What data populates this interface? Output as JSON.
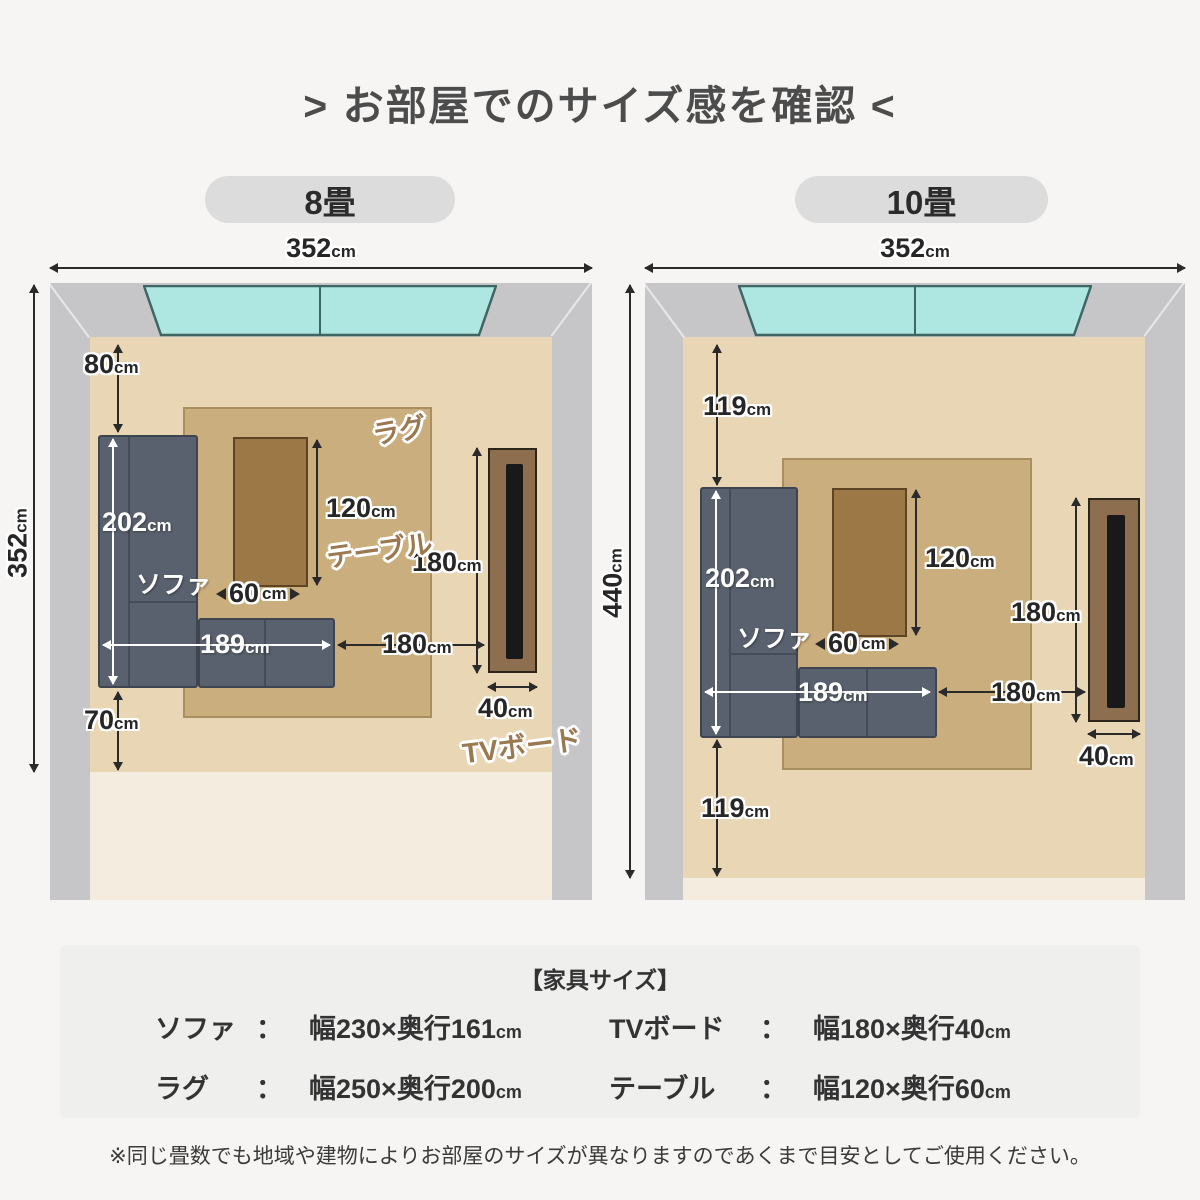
{
  "title": "> お部屋でのサイズ感を確認 <",
  "unit": "cm",
  "left": {
    "badge": "8畳",
    "width": "352",
    "height": "352",
    "top_gap": "80",
    "sofa_depth": "202",
    "sofa": "ソファ",
    "rug": "ラグ",
    "table": "テーブル",
    "table_h": "120",
    "table_w": "60",
    "sofa_w": "189",
    "dist": "180",
    "tv_h": "180",
    "tv_w": "40",
    "tv": "TVボード",
    "bottom_gap": "70"
  },
  "right": {
    "badge": "10畳",
    "width": "352",
    "height": "440",
    "top_gap": "119",
    "sofa_depth": "202",
    "sofa": "ソファ",
    "table_h": "120",
    "table_w": "60",
    "sofa_w": "189",
    "dist": "180",
    "tv_h": "180",
    "tv_w": "40",
    "bottom_gap": "119"
  },
  "panel": {
    "heading": "【家具サイズ】",
    "colon": "：",
    "items": [
      {
        "label": "ソファ",
        "value": "幅230×奥行161"
      },
      {
        "label": "TVボード",
        "value": "幅180×奥行40"
      },
      {
        "label": "ラグ",
        "value": "幅250×奥行200"
      },
      {
        "label": "テーブル",
        "value": "幅120×奥行60"
      }
    ]
  },
  "note": "※同じ畳数でも地域や建物によりお部屋のサイズが異なりますのであくまで目安としてご使用ください。",
  "colors": {
    "page_bg": "#f6f5f3",
    "wall": "#c6c6c8",
    "floor": "#e9d6b4",
    "floor_light": "#f3ecdf",
    "rug": "#cbae7e",
    "table": "#9d7847",
    "sofa": "#59616e",
    "sofa_border": "#3e4550",
    "window": "#aee7e2",
    "window_border": "#3f6663",
    "tv_board": "#8d6e4e",
    "tv_screen": "#19191b",
    "label_brown": "#9a7850",
    "badge_bg": "#dcdcdc",
    "panel_bg": "#efefee",
    "dim_text": "#262626"
  }
}
